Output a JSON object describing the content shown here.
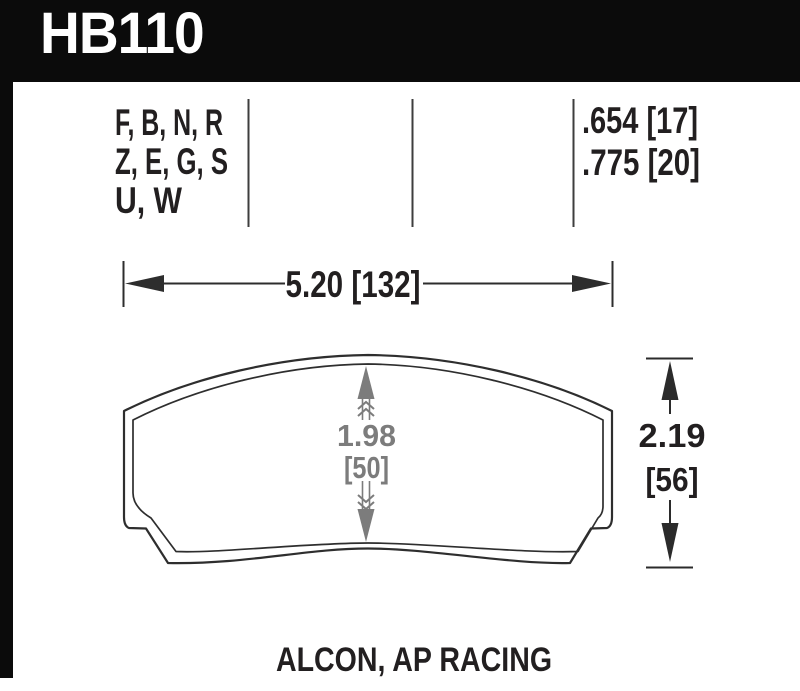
{
  "header": {
    "part_number": "HB110"
  },
  "compound_codes": {
    "line1": "F, B, N, R",
    "line2": "Z, E, G, S",
    "line3": "U, W"
  },
  "thickness": {
    "line1": ".654 [17]",
    "line2": ".775 [20]"
  },
  "dimensions": {
    "width": "5.20 [132]",
    "center_height_in": "1.98",
    "center_height_mm": "[50]",
    "overall_height_in": "2.19",
    "overall_height_mm": "[56]"
  },
  "footer": {
    "applications": "ALCON, AP RACING"
  },
  "colors": {
    "header_bg": "#0b0b0b",
    "header_text": "#ffffff",
    "line_black": "#2d2d2d",
    "text_black": "#221f20",
    "dimension_gray": "#7c7c7c",
    "divider_gray": "#3e3e3e"
  }
}
